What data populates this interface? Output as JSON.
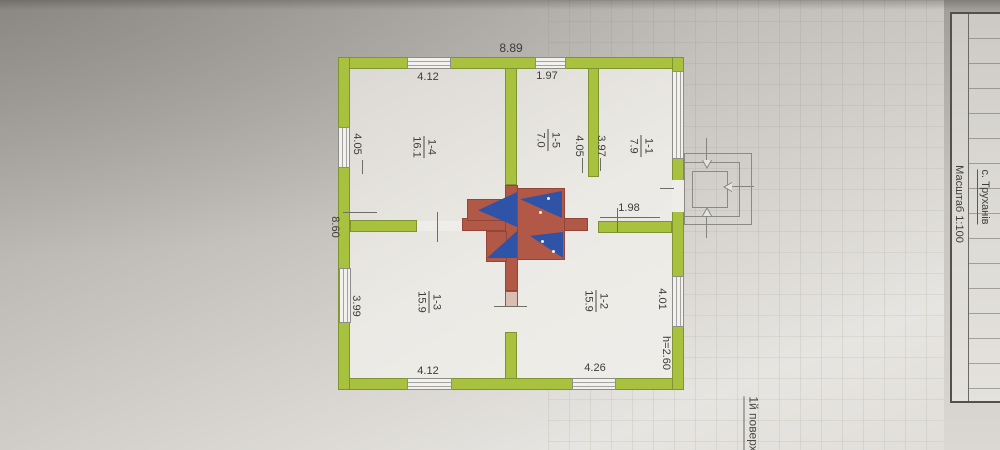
{
  "colors": {
    "wall_green": "#a8c13f",
    "stove_red": "#b25847",
    "stove_blue": "#2f53a6",
    "paper": "#e7e5e1"
  },
  "title_block": {
    "settlement": "с. Труханів",
    "scale": "Масштаб 1:100"
  },
  "floor_label": "1й поверх",
  "plan": {
    "overall_width": "8.89",
    "overall_depth": "8.60",
    "ceiling_height": "h=2.60",
    "dims": {
      "room14_width": "4.12",
      "room15_width": "1.97",
      "room14_depth": "4.05",
      "room13_depth": "3.99",
      "room15_depth": "4.05",
      "room11_depth": "3.97",
      "hall_width": "1.98",
      "room13_width": "4.12",
      "room12_width": "4.26",
      "room12_depth": "4.01"
    },
    "rooms": {
      "r11": {
        "number": "1-1",
        "area": "7.9"
      },
      "r12": {
        "number": "1-2",
        "area": "15.9"
      },
      "r13": {
        "number": "1-3",
        "area": "15.9"
      },
      "r14": {
        "number": "1-4",
        "area": "16.1"
      },
      "r15": {
        "number": "1-5",
        "area": "7.0"
      }
    }
  }
}
